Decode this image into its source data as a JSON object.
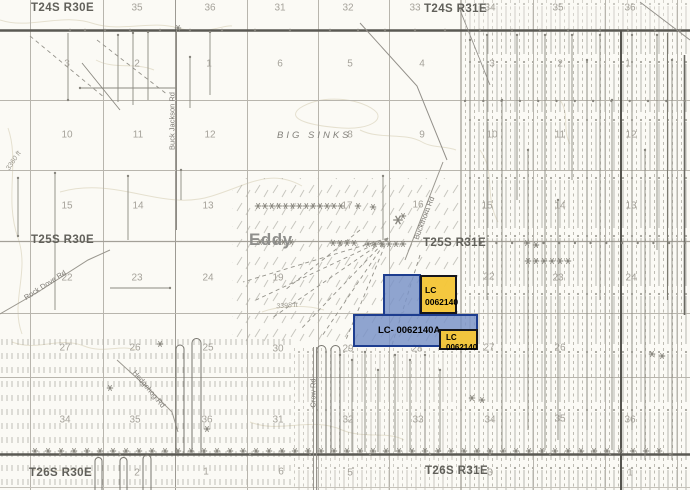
{
  "map": {
    "townships": [
      {
        "text": "T24S R30E",
        "x": 31,
        "y": 2
      },
      {
        "text": "T24S R31E",
        "x": 424,
        "y": 3
      },
      {
        "text": "T25S R30E",
        "x": 31,
        "y": 234
      },
      {
        "text": "T25S R31E",
        "x": 423,
        "y": 237
      },
      {
        "text": "T26S R30E",
        "x": 29,
        "y": 467
      },
      {
        "text": "T26S R31E",
        "x": 425,
        "y": 465
      }
    ],
    "places": [
      {
        "text": "BIG SINKS",
        "x": 277,
        "y": 130,
        "kind": "feature"
      },
      {
        "text": "Eddy",
        "x": 249,
        "y": 230,
        "kind": "county"
      }
    ],
    "elevations": [
      {
        "text": "3360 ft",
        "x": 14,
        "y": 161,
        "rot": -57
      },
      {
        "text": "3398 ft",
        "x": 287,
        "y": 306,
        "rot": -4
      }
    ],
    "roads": [
      {
        "name": "Buck Jackson Rd",
        "x": 172,
        "y": 121,
        "rot": -90
      },
      {
        "name": "Rock Dove Rd",
        "x": 45,
        "y": 285,
        "rot": -33
      },
      {
        "name": "Buckthorn Rd",
        "x": 424,
        "y": 218,
        "rot": -69
      },
      {
        "name": "Crow Rd",
        "x": 313,
        "y": 393,
        "rot": -90
      },
      {
        "name": "Hedgehog Rd",
        "x": 149,
        "y": 389,
        "rot": 50
      }
    ],
    "sections": [
      {
        "n": "35",
        "x": 137,
        "y": 8
      },
      {
        "n": "36",
        "x": 210,
        "y": 8
      },
      {
        "n": "31",
        "x": 280,
        "y": 8
      },
      {
        "n": "32",
        "x": 348,
        "y": 8
      },
      {
        "n": "33",
        "x": 415,
        "y": 8
      },
      {
        "n": "34",
        "x": 490,
        "y": 8
      },
      {
        "n": "35",
        "x": 558,
        "y": 8
      },
      {
        "n": "36",
        "x": 630,
        "y": 8
      },
      {
        "n": "3",
        "x": 67,
        "y": 64
      },
      {
        "n": "2",
        "x": 137,
        "y": 64
      },
      {
        "n": "1",
        "x": 209,
        "y": 64
      },
      {
        "n": "6",
        "x": 280,
        "y": 64
      },
      {
        "n": "5",
        "x": 350,
        "y": 64
      },
      {
        "n": "4",
        "x": 422,
        "y": 64
      },
      {
        "n": "3",
        "x": 492,
        "y": 64
      },
      {
        "n": "2",
        "x": 560,
        "y": 64
      },
      {
        "n": "1",
        "x": 628,
        "y": 64
      },
      {
        "n": "10",
        "x": 67,
        "y": 135
      },
      {
        "n": "11",
        "x": 138,
        "y": 135
      },
      {
        "n": "12",
        "x": 210,
        "y": 135
      },
      {
        "n": "8",
        "x": 350,
        "y": 135
      },
      {
        "n": "9",
        "x": 422,
        "y": 135
      },
      {
        "n": "10",
        "x": 492,
        "y": 135
      },
      {
        "n": "11",
        "x": 560,
        "y": 135
      },
      {
        "n": "12",
        "x": 631,
        "y": 135
      },
      {
        "n": "15",
        "x": 67,
        "y": 206
      },
      {
        "n": "14",
        "x": 138,
        "y": 206
      },
      {
        "n": "13",
        "x": 208,
        "y": 206
      },
      {
        "n": "17",
        "x": 347,
        "y": 206
      },
      {
        "n": "16",
        "x": 418,
        "y": 205
      },
      {
        "n": "15",
        "x": 487,
        "y": 206
      },
      {
        "n": "14",
        "x": 560,
        "y": 206
      },
      {
        "n": "13",
        "x": 631,
        "y": 206
      },
      {
        "n": "22",
        "x": 67,
        "y": 278
      },
      {
        "n": "23",
        "x": 137,
        "y": 278
      },
      {
        "n": "24",
        "x": 208,
        "y": 278
      },
      {
        "n": "19",
        "x": 278,
        "y": 278
      },
      {
        "n": "22",
        "x": 489,
        "y": 277
      },
      {
        "n": "23",
        "x": 558,
        "y": 278
      },
      {
        "n": "24",
        "x": 631,
        "y": 278
      },
      {
        "n": "27",
        "x": 65,
        "y": 348
      },
      {
        "n": "26",
        "x": 135,
        "y": 348
      },
      {
        "n": "25",
        "x": 208,
        "y": 348
      },
      {
        "n": "30",
        "x": 278,
        "y": 349
      },
      {
        "n": "29",
        "x": 348,
        "y": 349
      },
      {
        "n": "28",
        "x": 417,
        "y": 349
      },
      {
        "n": "27",
        "x": 489,
        "y": 348
      },
      {
        "n": "26",
        "x": 560,
        "y": 348
      },
      {
        "n": "34",
        "x": 65,
        "y": 420
      },
      {
        "n": "35",
        "x": 135,
        "y": 420
      },
      {
        "n": "36",
        "x": 207,
        "y": 420
      },
      {
        "n": "31",
        "x": 278,
        "y": 420
      },
      {
        "n": "32",
        "x": 348,
        "y": 420
      },
      {
        "n": "33",
        "x": 418,
        "y": 420
      },
      {
        "n": "34",
        "x": 490,
        "y": 420
      },
      {
        "n": "35",
        "x": 560,
        "y": 419
      },
      {
        "n": "36",
        "x": 630,
        "y": 420
      },
      {
        "n": "2",
        "x": 137,
        "y": 473
      },
      {
        "n": "1",
        "x": 206,
        "y": 472
      },
      {
        "n": "6",
        "x": 281,
        "y": 472
      },
      {
        "n": "5",
        "x": 350,
        "y": 473
      },
      {
        "n": "3",
        "x": 490,
        "y": 473
      },
      {
        "n": "1",
        "x": 630,
        "y": 473
      }
    ],
    "parcels": [
      {
        "id": "parcel-blue-north",
        "type": "blue",
        "x": 383,
        "y": 274,
        "w": 38,
        "h": 42,
        "lines": [],
        "lx": 0,
        "ly": 0,
        "fs": 8.5,
        "lh": 12
      },
      {
        "id": "parcel-blue-main",
        "type": "blue",
        "x": 353,
        "y": 314,
        "w": 125,
        "h": 33,
        "lines": [
          "LC- 0062140A"
        ],
        "lx": 23,
        "ly": 9,
        "fs": 9.5,
        "lh": 12
      },
      {
        "id": "parcel-yellow-north",
        "type": "yellow",
        "x": 420,
        "y": 275,
        "w": 37,
        "h": 39,
        "lines": [
          "LC",
          "0062140"
        ],
        "lx": 3,
        "ly": 7,
        "fs": 8.5,
        "lh": 12
      },
      {
        "id": "parcel-yellow-south",
        "type": "yellow",
        "x": 439,
        "y": 329,
        "w": 39,
        "h": 21,
        "lines": [
          "LC",
          "0062140"
        ],
        "lx": 5,
        "ly": 2,
        "fs": 8,
        "lh": 10
      }
    ],
    "colors": {
      "parcel_blue": "#7a93c7",
      "parcel_blue_border": "#1d3d8f",
      "parcel_yellow": "#f5c639",
      "parcel_yellow_border": "#16161c",
      "township_line": "#5a5953",
      "section_line": "#b8b5ad",
      "label_gray": "#a5a29a"
    }
  }
}
